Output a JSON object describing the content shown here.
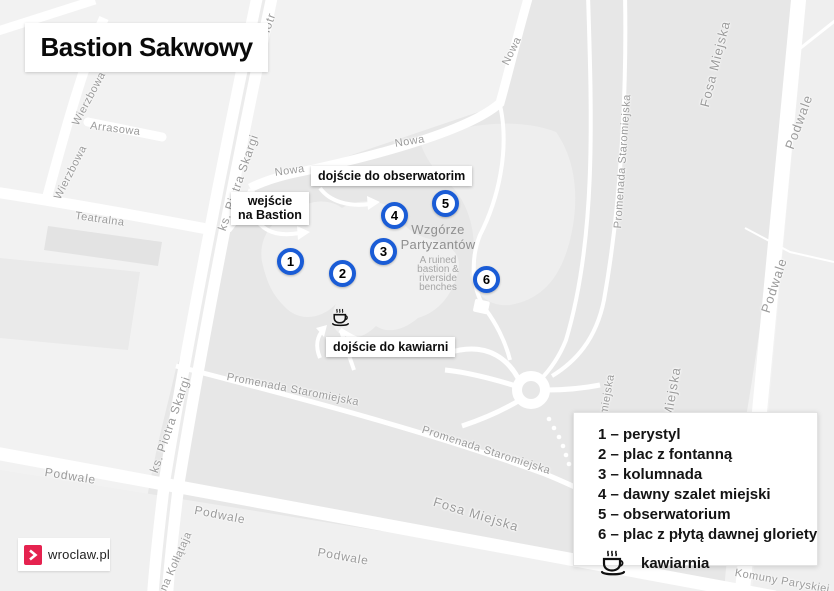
{
  "title": "Bastion Sakwowy",
  "colors": {
    "marker_blue": "#1a5cd6",
    "brand_pink": "#e5224f",
    "map_background": "#f2f2f2",
    "map_green_gray": "#e7e7e7",
    "street_label_gray": "#9b9b9b"
  },
  "callouts": {
    "entrance_line1": "wejście",
    "entrance_line2": "na Bastion",
    "observatory": "dojście do obserwatorim",
    "cafe": "dojście do kawiarni"
  },
  "markers": [
    "1",
    "2",
    "3",
    "4",
    "5",
    "6"
  ],
  "poi": {
    "name_line1": "Wzgórze",
    "name_line2": "Partyzantów",
    "desc_line1": "A ruined",
    "desc_line2": "bastion &",
    "desc_line3": "riverside",
    "desc_line4": "benches"
  },
  "legend": {
    "items": [
      "1 – perystyl",
      "2 – plac z fontanną",
      "3 – kolumnada",
      "4 – dawny szalet miejski",
      "5 – obserwatorium",
      "6 – plac z płytą dawnej gloriety"
    ],
    "cafe_label": "kawiarnia",
    "cafe_icon": "coffee-cup-icon"
  },
  "logo": {
    "text": "wroclaw.pl",
    "chevron_icon": "chevron-right-icon"
  },
  "streets": {
    "wierzbowa_1": "Wierzbowa",
    "wierzbowa_2": "Wierzbowa",
    "arrasowa": "Arrasowa",
    "teatralna": "Teatralna",
    "piotra_skargi_fragment": "Piotr",
    "piotra_skargi_1": "ks. Piotra Skargi",
    "piotra_skargi_2": "ks. Piotra Skargi",
    "nowa_1": "Nowa",
    "nowa_2": "Nowa",
    "nowa_3": "Nowa",
    "fosa_miejska_top": "Fosa Miejska",
    "fosa_miejska_mid_fragment": "Miejska",
    "fosa_miejska_bottom": "Fosa Miejska",
    "podwale_right_1": "Podwale",
    "podwale_right_2": "Podwale",
    "podwale_left": "Podwale",
    "podwale_bottom_1": "Podwale",
    "podwale_bottom_2": "Podwale",
    "promenada_1": "Promenada Staromiejska",
    "promenada_2": "Promenada Staromiejska",
    "promenada_vertical": "Promenada Staromiejska",
    "promenada_vertical_fragment": "omiejska",
    "kollataja_fragment": "ona Kołłątaja",
    "komuny_paryskiej": "Komuny Paryskiej"
  }
}
